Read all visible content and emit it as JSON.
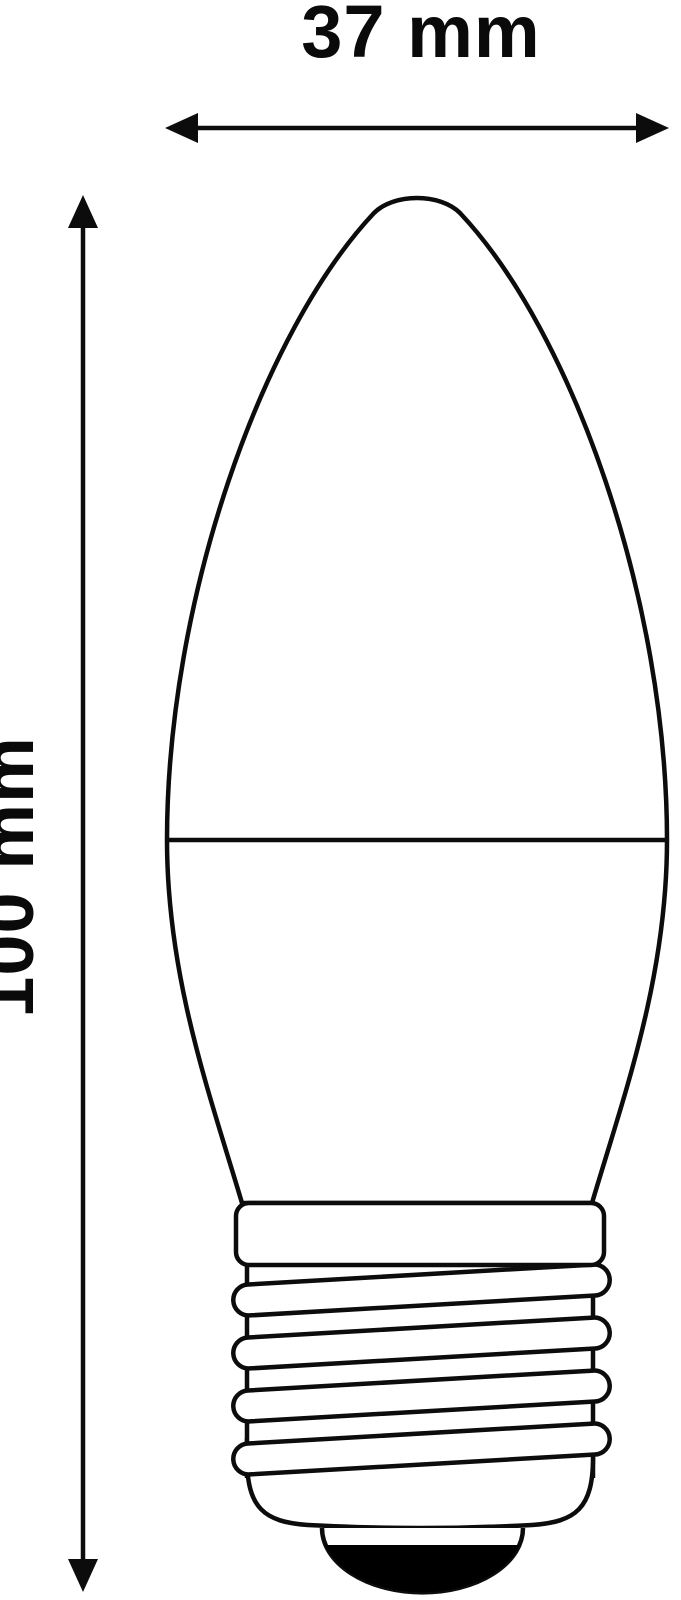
{
  "figure": {
    "title": "Bulb dimension diagram",
    "subject": "Candle-shaped bulb (C37) with E27 screw base, line drawing with dimension arrows",
    "background_color": "#ffffff",
    "line_color": "#0c0c0c",
    "text_color": "#0a0a0a",
    "contact_tip_fill": "#000000",
    "dimensions": {
      "width": {
        "label": "37 mm",
        "value": 37,
        "unit": "mm"
      },
      "height": {
        "label": "100 mm",
        "value": 100,
        "unit": "mm"
      }
    },
    "icons": {
      "width_arrow": "horizontal-double-headed-arrow",
      "height_arrow": "vertical-double-headed-arrow"
    }
  }
}
